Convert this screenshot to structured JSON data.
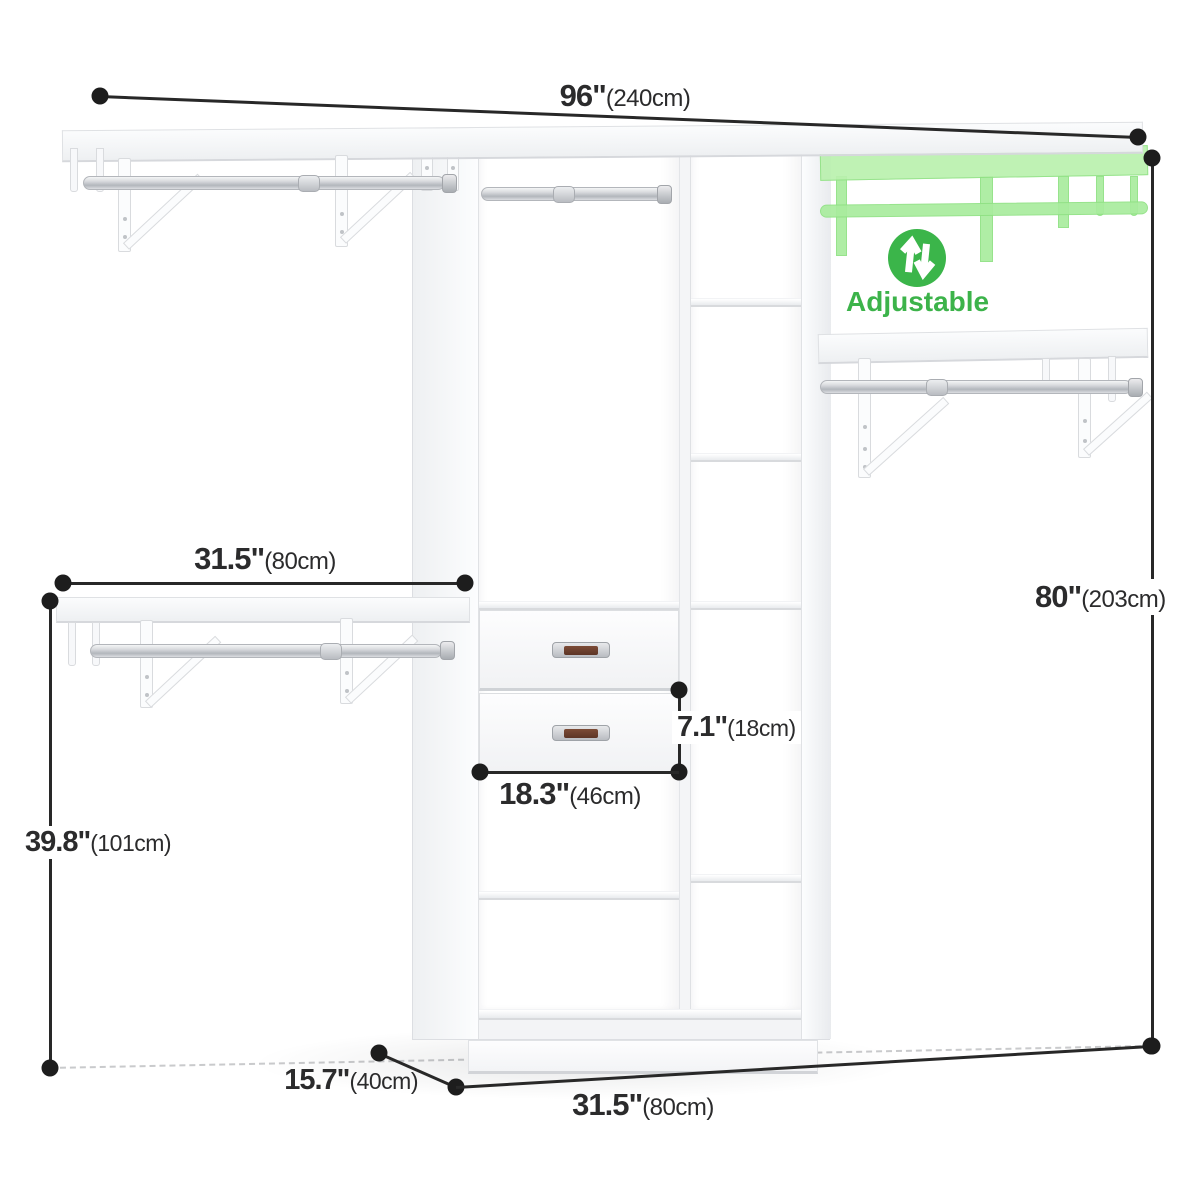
{
  "colors": {
    "dimension_line": "#282828",
    "dimension_text": "#2b2b2c",
    "accent_green": "#3cb34a",
    "ghost_green": "#a9ec9e",
    "product_white": "#f7f8fa"
  },
  "adjustable_badge": {
    "icon": "adjustable-arrows-icon",
    "label": "Adjustable"
  },
  "dimensions": {
    "top_width": {
      "value": "96\"",
      "metric": "(240cm)"
    },
    "left_shelf_width": {
      "value": "31.5\"",
      "metric": "(80cm)"
    },
    "left_height": {
      "value": "39.8\"",
      "metric": "(101cm)"
    },
    "right_height": {
      "value": "80\"",
      "metric": "(203cm)"
    },
    "drawer_height": {
      "value": "7.1\"",
      "metric": "(18cm)"
    },
    "drawer_width": {
      "value": "18.3\"",
      "metric": "(46cm)"
    },
    "depth": {
      "value": "15.7\"",
      "metric": "(40cm)"
    },
    "bottom_width": {
      "value": "31.5\"",
      "metric": "(80cm)"
    }
  }
}
